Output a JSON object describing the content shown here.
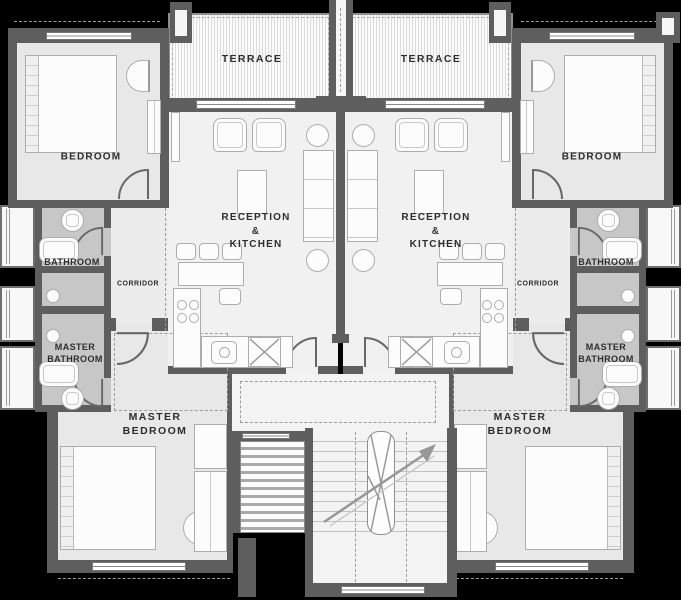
{
  "meta": {
    "type": "architectural floor plan",
    "units": "two mirrored apartments with central staircase"
  },
  "colors": {
    "background": "#000000",
    "wall": "#5e5e5e",
    "floor": "#e8e8e8",
    "bathroom_floor": "#c7c7c7",
    "label_text": "#2d2d2d"
  },
  "rooms": {
    "terrace_left": {
      "label": "TERRACE"
    },
    "terrace_right": {
      "label": "TERRACE"
    },
    "bedroom_left": {
      "label": "BEDROOM"
    },
    "bedroom_right": {
      "label": "BEDROOM"
    },
    "reception_left": {
      "label": "RECEPTION &\nKITCHEN"
    },
    "reception_right": {
      "label": "RECEPTION &\nKITCHEN"
    },
    "bathroom_left": {
      "label": "BATHROOM"
    },
    "bathroom_right": {
      "label": "BATHROOM"
    },
    "corridor_left": {
      "label": "CORRIDOR"
    },
    "corridor_right": {
      "label": "CORRIDOR"
    },
    "master_bathroom_left": {
      "label": "MASTER\nBATHROOM"
    },
    "master_bathroom_right": {
      "label": "MASTER\nBATHROOM"
    },
    "master_bedroom_left": {
      "label": "MASTER\nBEDROOM"
    },
    "master_bedroom_right": {
      "label": "MASTER\nBEDROOM"
    }
  }
}
